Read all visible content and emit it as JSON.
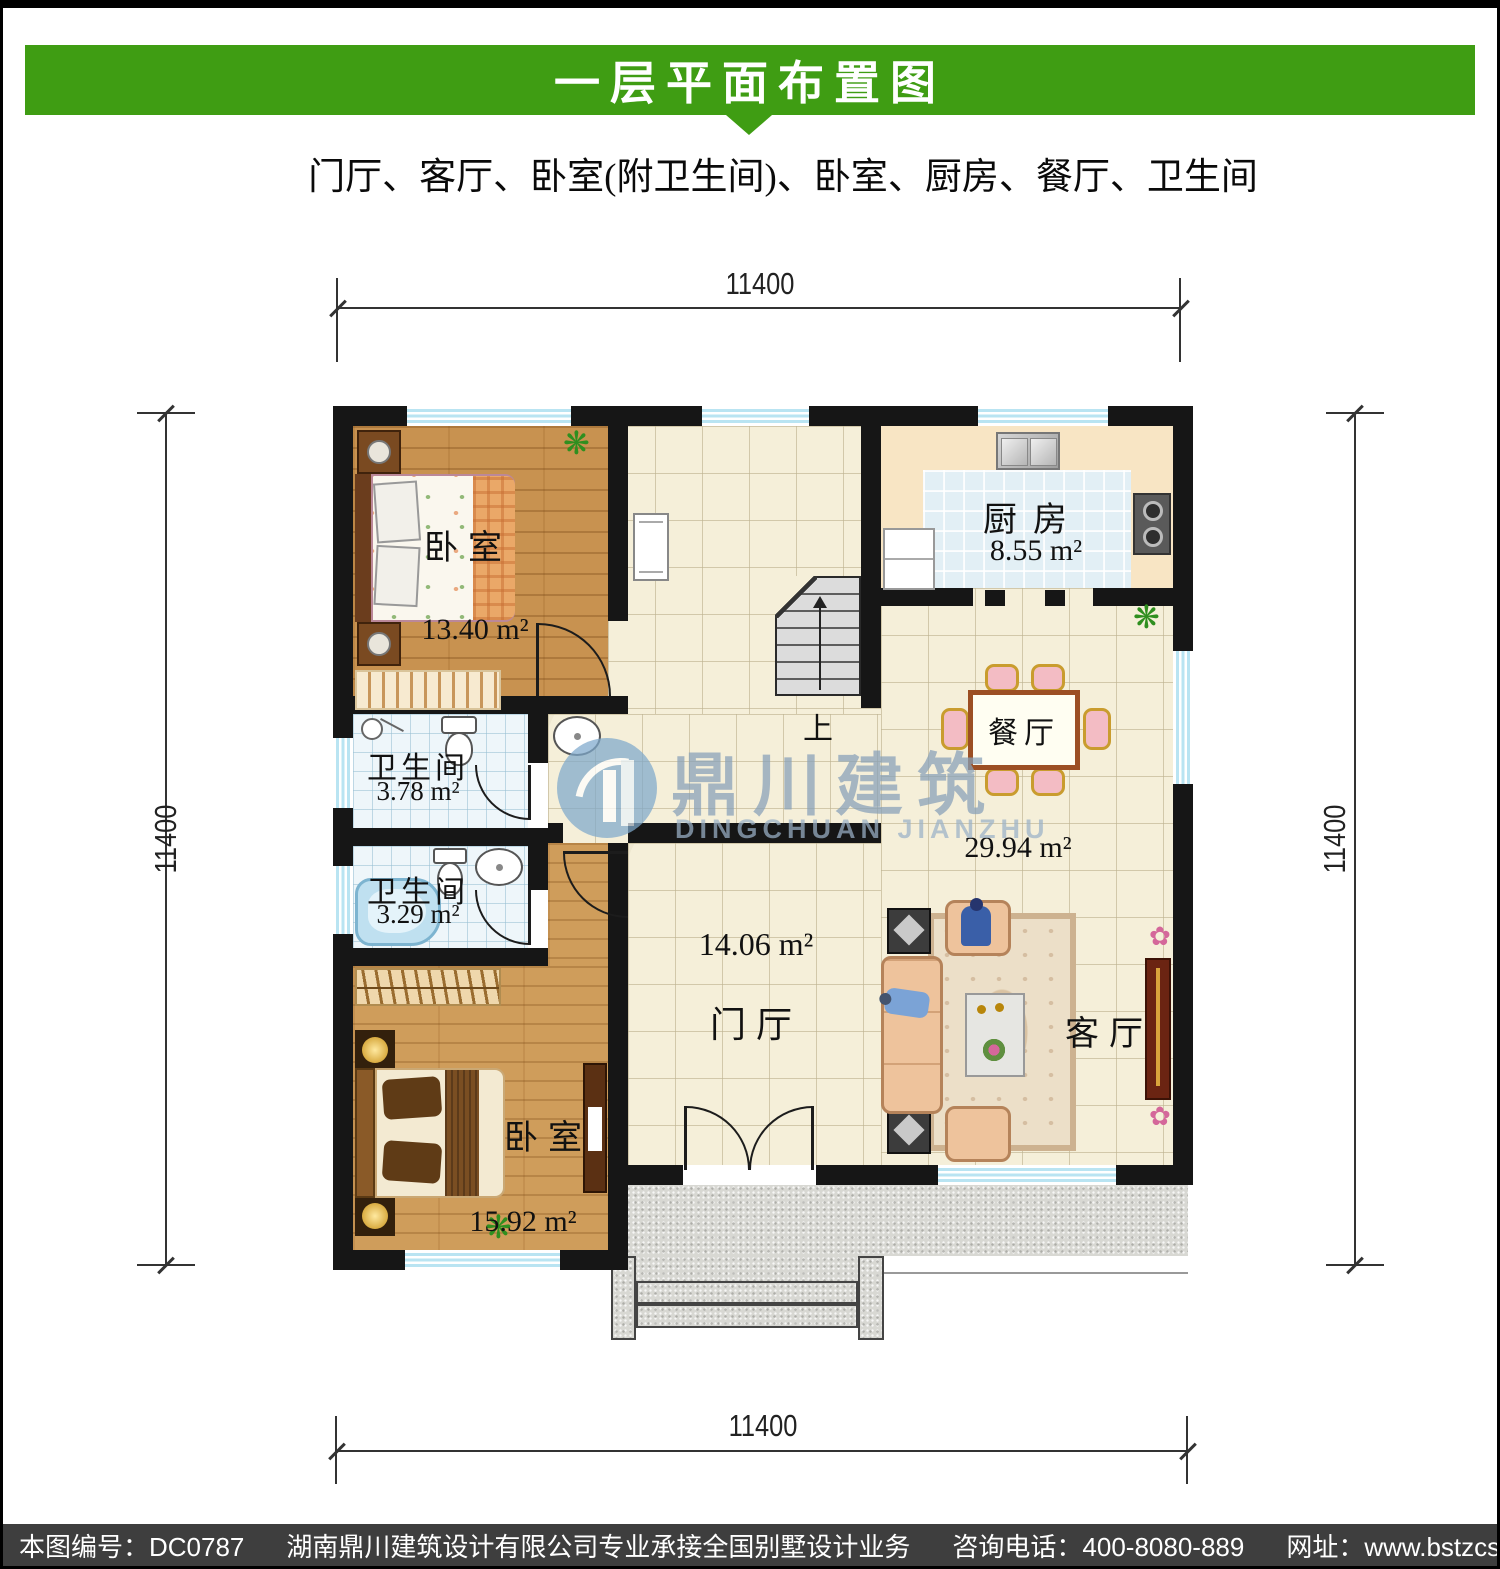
{
  "header": {
    "title": "一层平面布置图",
    "subtitle": "门厅、客厅、卧室(附卫生间)、卧室、厨房、餐厅、卫生间"
  },
  "dimensions": {
    "top": "11400",
    "bottom": "11400",
    "left": "11400",
    "right": "11400"
  },
  "rooms": {
    "bedroom1": {
      "name": "卧室",
      "area": "13.40 m²"
    },
    "bedroom2": {
      "name": "卧室",
      "area": "15.92 m²"
    },
    "kitchen": {
      "name": "厨房",
      "area": "8.55 m²"
    },
    "dining": {
      "name": "餐厅",
      "area": "29.94 m²"
    },
    "bath1": {
      "name": "卫生间",
      "area": "3.78 m²"
    },
    "bath2": {
      "name": "卫生间",
      "area": "3.29 m²"
    },
    "foyer": {
      "name": "门厅",
      "area": "14.06 m²"
    },
    "living": {
      "name": "客厅"
    }
  },
  "stairs": {
    "up_label": "上"
  },
  "watermark": {
    "cn": "鼎川建筑",
    "en": "DINGCHUAN JIANZHU"
  },
  "icons": {
    "plant": "❋",
    "flower": "✿"
  },
  "colors": {
    "accent_green": "#3f9d13",
    "footer_gray": "#3e3e3e",
    "window_blue": "#b9e4f2"
  },
  "footer": {
    "sheet_no": "本图编号：DC0787",
    "company": "湖南鼎川建筑设计有限公司专业承接全国别墅设计业务",
    "phone": "咨询电话：400-8080-889",
    "website": "网址：www.bstzcs.com"
  }
}
